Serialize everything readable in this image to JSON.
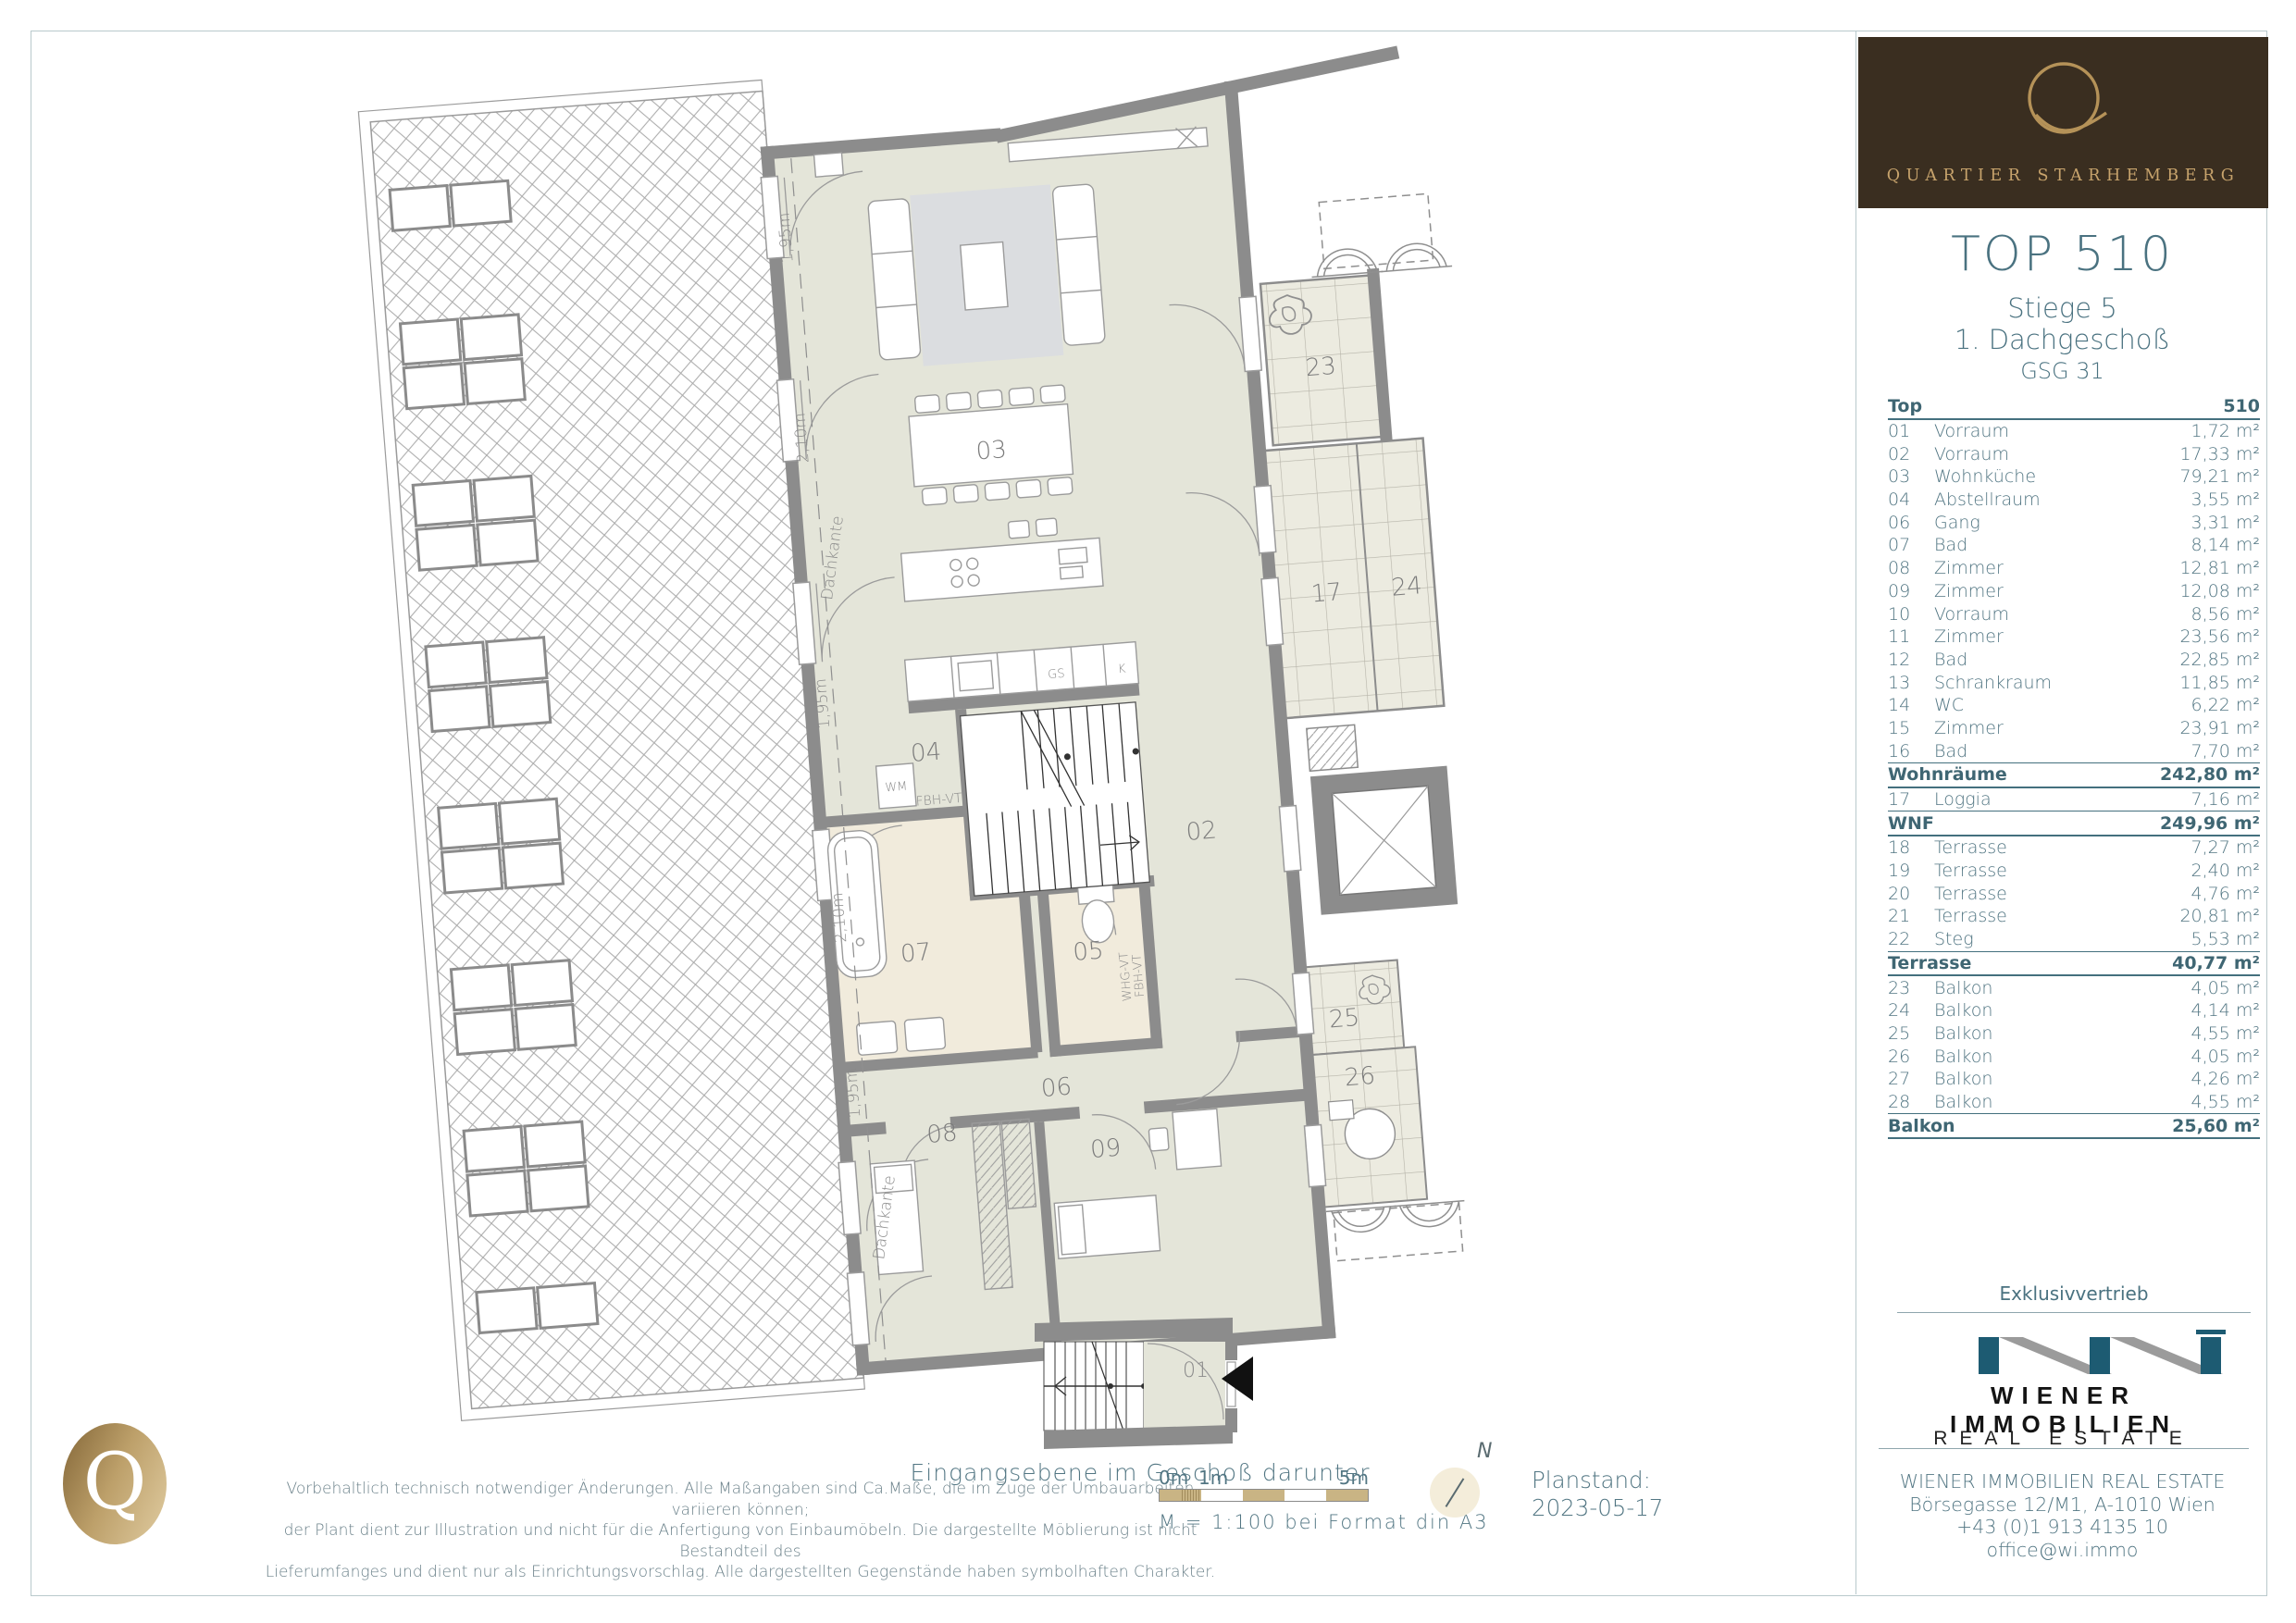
{
  "brand": {
    "logo_letter": "Q",
    "logo_text": "QUARTIER STARHEMBERG"
  },
  "unit": {
    "top": "TOP 510",
    "stiege": "Stiege 5",
    "floor": "1. Dachgeschoß",
    "code": "GSG 31"
  },
  "area_table": {
    "header_left": "Top",
    "header_right": "510",
    "rows": [
      {
        "kind": "item",
        "num": "01",
        "name": "Vorraum",
        "area": "1,72 m²"
      },
      {
        "kind": "item",
        "num": "02",
        "name": "Vorraum",
        "area": "17,33 m²"
      },
      {
        "kind": "item",
        "num": "03",
        "name": "Wohnküche",
        "area": "79,21 m²"
      },
      {
        "kind": "item",
        "num": "04",
        "name": "Abstellraum",
        "area": "3,55 m²"
      },
      {
        "kind": "item",
        "num": "06",
        "name": "Gang",
        "area": "3,31 m²"
      },
      {
        "kind": "item",
        "num": "07",
        "name": "Bad",
        "area": "8,14 m²"
      },
      {
        "kind": "item",
        "num": "08",
        "name": "Zimmer",
        "area": "12,81 m²"
      },
      {
        "kind": "item",
        "num": "09",
        "name": "Zimmer",
        "area": "12,08 m²"
      },
      {
        "kind": "item",
        "num": "10",
        "name": "Vorraum",
        "area": "8,56 m²"
      },
      {
        "kind": "item",
        "num": "11",
        "name": "Zimmer",
        "area": "23,56 m²"
      },
      {
        "kind": "item",
        "num": "12",
        "name": "Bad",
        "area": "22,85 m²"
      },
      {
        "kind": "item",
        "num": "13",
        "name": "Schrankraum",
        "area": "11,85 m²"
      },
      {
        "kind": "item",
        "num": "14",
        "name": "WC",
        "area": "6,22 m²"
      },
      {
        "kind": "item",
        "num": "15",
        "name": "Zimmer",
        "area": "23,91 m²"
      },
      {
        "kind": "item",
        "num": "16",
        "name": "Bad",
        "area": "7,70 m²"
      },
      {
        "kind": "subtotal",
        "num": "",
        "name": "Wohnräume",
        "area": "242,80 m²"
      },
      {
        "kind": "item",
        "num": "17",
        "name": "Loggia",
        "area": "7,16 m²"
      },
      {
        "kind": "subtotal",
        "num": "",
        "name": "WNF",
        "area": "249,96 m²"
      },
      {
        "kind": "item",
        "num": "18",
        "name": "Terrasse",
        "area": "7,27 m²"
      },
      {
        "kind": "item",
        "num": "19",
        "name": "Terrasse",
        "area": "2,40 m²"
      },
      {
        "kind": "item",
        "num": "20",
        "name": "Terrasse",
        "area": "4,76 m²"
      },
      {
        "kind": "item",
        "num": "21",
        "name": "Terrasse",
        "area": "20,81 m²"
      },
      {
        "kind": "item",
        "num": "22",
        "name": "Steg",
        "area": "5,53 m²"
      },
      {
        "kind": "subtotal",
        "num": "",
        "name": "Terrasse",
        "area": "40,77 m²"
      },
      {
        "kind": "item",
        "num": "23",
        "name": "Balkon",
        "area": "4,05 m²"
      },
      {
        "kind": "item",
        "num": "24",
        "name": "Balkon",
        "area": "4,14 m²"
      },
      {
        "kind": "item",
        "num": "25",
        "name": "Balkon",
        "area": "4,55 m²"
      },
      {
        "kind": "item",
        "num": "26",
        "name": "Balkon",
        "area": "4,05 m²"
      },
      {
        "kind": "item",
        "num": "27",
        "name": "Balkon",
        "area": "4,26 m²"
      },
      {
        "kind": "item",
        "num": "28",
        "name": "Balkon",
        "area": "4,55 m²"
      },
      {
        "kind": "subtotal",
        "num": "",
        "name": "Balkon",
        "area": "25,60 m²"
      }
    ]
  },
  "distribution": {
    "label": "Exklusivvertrieb",
    "company_top": "WIENER IMMOBILIEN",
    "company_bottom": "REAL ESTATE",
    "contact": [
      "WIENER IMMOBILIEN REAL ESTATE",
      "Börsegasse 12/M1, A-1010 Wien",
      "+43 (0)1 913 4135 10",
      "office@wi.immo"
    ]
  },
  "footer": {
    "disclaimer": [
      "Vorbehaltlich technisch notwendiger Änderungen. Alle Maßangaben sind Ca.Maße, die im Zuge der Umbauarbeiten variieren können;",
      "der Plant dient zur Illustration und nicht für die Anfertigung von Einbaumöbeln. Die dargestellte Möblierung ist nicht Bestandteil des",
      "Lieferumfanges und dient nur als Einrichtungsvorschlag. Alle dargestellten Gegenstände haben symbolhaften Charakter."
    ],
    "scale": {
      "m0": "0m",
      "m1": "1m",
      "m5": "5m",
      "text": "M = 1:100 bei Format din A3"
    },
    "north": "N",
    "plan_status_label": "Planstand:",
    "plan_status_date": "2023-05-17"
  },
  "plan": {
    "caption": "Eingangsebene im Geschoß darunter",
    "rooms": {
      "r01": "01",
      "r02": "02",
      "r03": "03",
      "r04": "04",
      "r05": "05",
      "r06": "06",
      "r07": "07",
      "r08": "08",
      "r09": "09",
      "r17": "17",
      "r23": "23",
      "r24": "24",
      "r25": "25",
      "r26": "26"
    },
    "annotations": {
      "dachkante": "Dachkante",
      "h195": "1,95m",
      "h210": "2,10m",
      "wm": "WM",
      "gs": "GS",
      "k": "K",
      "fbh": "FBH-VT",
      "whg": "WHG-VT",
      "fbh2": "FBH-VT"
    }
  },
  "colors": {
    "teal": "#4a7280",
    "table_text": "#527683",
    "brown": "#3a2e20",
    "gold": "#c7a36c",
    "wi_blue": "#1d5b72",
    "floor": "#e4e5d9",
    "bath_floor": "#f1ebdc",
    "tile": "#ecebe0",
    "wall": "#8c8c8c",
    "scale_tan": "#c9b484"
  }
}
